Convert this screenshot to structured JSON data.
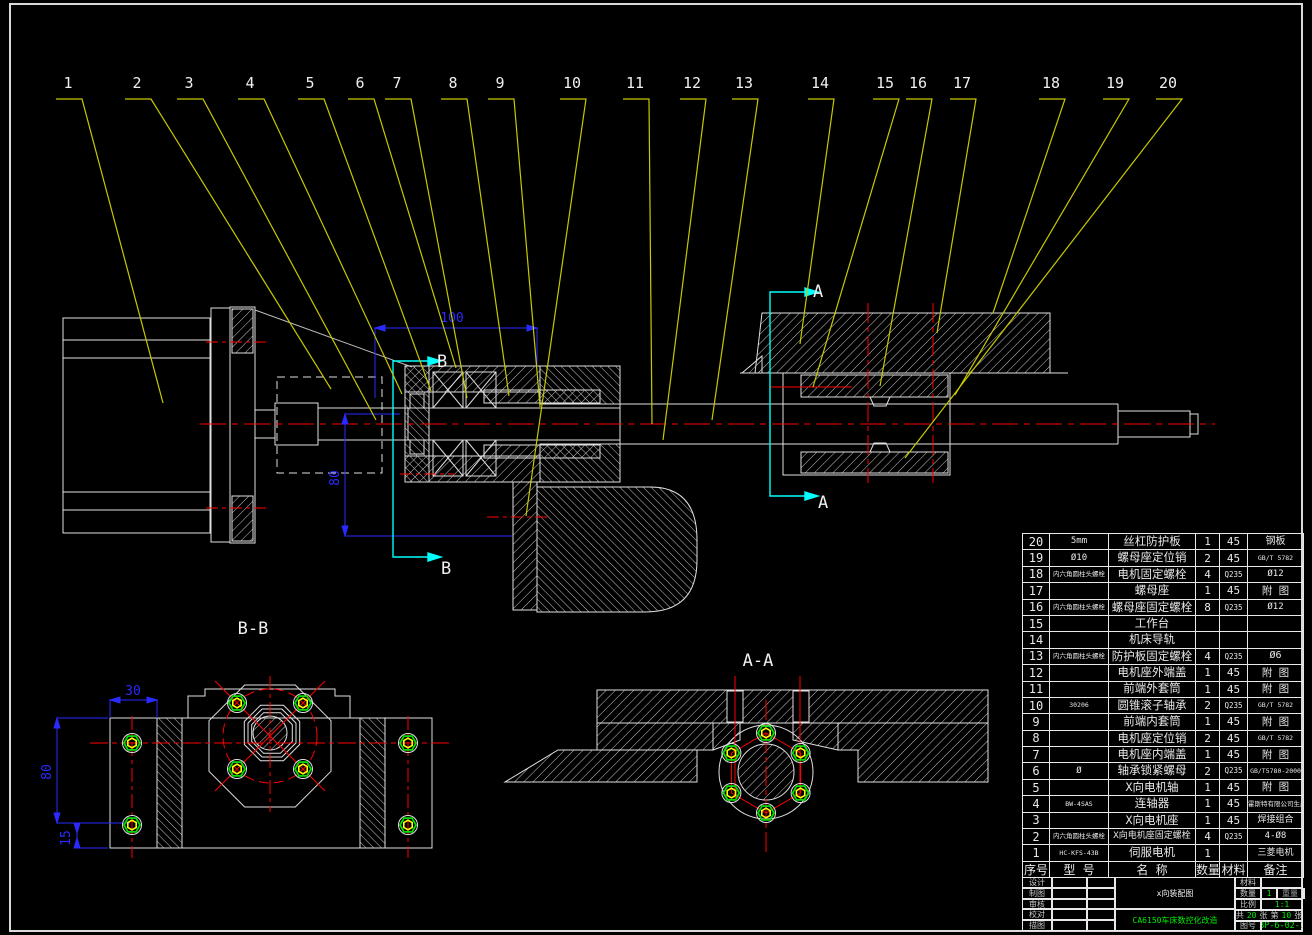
{
  "colors": {
    "background": "#000000",
    "line": "#e0e0e0",
    "leader_yellow": "#c8c800",
    "dimension_blue": "#2a2aff",
    "section_cyan": "#00ffff",
    "centerline_red": "#ff0000",
    "green": "#00ee00",
    "bolt_green": "#00dd00",
    "bolt_yellow": "#ffff00"
  },
  "callouts": [
    "1",
    "2",
    "3",
    "4",
    "5",
    "6",
    "7",
    "8",
    "9",
    "10",
    "11",
    "12",
    "13",
    "14",
    "15",
    "16",
    "17",
    "18",
    "19",
    "20"
  ],
  "views": {
    "bb": "B-B",
    "aa": "A-A",
    "section_b": "B",
    "section_a": "A"
  },
  "dims": {
    "main_width": "100",
    "main_height": "80",
    "bb_width": "30",
    "bb_height": "80",
    "bb_offset": "15"
  },
  "bom": {
    "header": {
      "seq": "序号",
      "model": "型  号",
      "name": "名      称",
      "qty": "数量",
      "mat": "材料",
      "note": "备注"
    },
    "rows": [
      {
        "seq": "20",
        "model": "5mm",
        "name": "丝杠防护板",
        "qty": "1",
        "mat": "45",
        "note": "钢板"
      },
      {
        "seq": "19",
        "model": "Ø10",
        "name": "螺母座定位销",
        "qty": "2",
        "mat": "45",
        "note": "GB/T 5782"
      },
      {
        "seq": "18",
        "model": "内六角圆柱头螺栓",
        "name": "电机固定螺栓",
        "qty": "4",
        "mat": "Q235",
        "note": "Ø12"
      },
      {
        "seq": "17",
        "model": "",
        "name": "螺母座",
        "qty": "1",
        "mat": "45",
        "note": "附    图"
      },
      {
        "seq": "16",
        "model": "内六角圆柱头螺栓",
        "name": "螺母座固定螺栓",
        "qty": "8",
        "mat": "Q235",
        "note": "Ø12"
      },
      {
        "seq": "15",
        "model": "",
        "name": "工作台",
        "qty": "",
        "mat": "",
        "note": ""
      },
      {
        "seq": "14",
        "model": "",
        "name": "机床导轨",
        "qty": "",
        "mat": "",
        "note": ""
      },
      {
        "seq": "13",
        "model": "内六角圆柱头螺栓",
        "name": "防护板固定螺栓",
        "qty": "4",
        "mat": "Q235",
        "note": "Ø6"
      },
      {
        "seq": "12",
        "model": "",
        "name": "电机座外端盖",
        "qty": "1",
        "mat": "45",
        "note": "附    图"
      },
      {
        "seq": "11",
        "model": "",
        "name": "前端外套筒",
        "qty": "1",
        "mat": "45",
        "note": "附    图"
      },
      {
        "seq": "10",
        "model": "30206",
        "name": "圆锥滚子轴承",
        "qty": "2",
        "mat": "Q235",
        "note": "GB/T 5782"
      },
      {
        "seq": "9",
        "model": "",
        "name": "前端内套筒",
        "qty": "1",
        "mat": "45",
        "note": "附    图"
      },
      {
        "seq": "8",
        "model": "",
        "name": "电机座定位销",
        "qty": "2",
        "mat": "45",
        "note": "GB/T 5782"
      },
      {
        "seq": "7",
        "model": "",
        "name": "电机座内端盖",
        "qty": "1",
        "mat": "45",
        "note": "附    图"
      },
      {
        "seq": "6",
        "model": "Ø",
        "name": "轴承锁紧螺母",
        "qty": "2",
        "mat": "Q235",
        "note": "GB/T5780-2000"
      },
      {
        "seq": "5",
        "model": "",
        "name": "X向电机轴",
        "qty": "1",
        "mat": "45",
        "note": "附    图"
      },
      {
        "seq": "4",
        "model": "BW-4SAS",
        "name": "连轴器",
        "qty": "1",
        "mat": "45",
        "note": "霍斯特有限公司生产"
      },
      {
        "seq": "3",
        "model": "",
        "name": "X向电机座",
        "qty": "1",
        "mat": "45",
        "note": "焊接组合"
      },
      {
        "seq": "2",
        "model": "内六角圆柱头螺栓",
        "name": "X向电机座固定螺栓",
        "qty": "4",
        "mat": "Q235",
        "note": "4-Ø8"
      },
      {
        "seq": "1",
        "model": "HC-KFS-43B",
        "name": "伺服电机",
        "qty": "1",
        "mat": "",
        "note": "三菱电机"
      }
    ]
  },
  "title_block": {
    "roles": [
      "设计",
      "制图",
      "审核",
      "校对",
      "描图"
    ],
    "drawing_title": "x向装配图",
    "project": "CA6150车床数控化改造",
    "material_label": "材料",
    "qty_label": "数量",
    "qty": "1",
    "weight_label": "重量",
    "scale_label": "比例",
    "scale": "1:1",
    "sheets": {
      "l1": "共",
      "total": "20",
      "l2": "张",
      "l3": "第",
      "page": "10",
      "l4": "张"
    },
    "drawing_no_label": "图号",
    "drawing_no": "2BP-6-02-10"
  }
}
